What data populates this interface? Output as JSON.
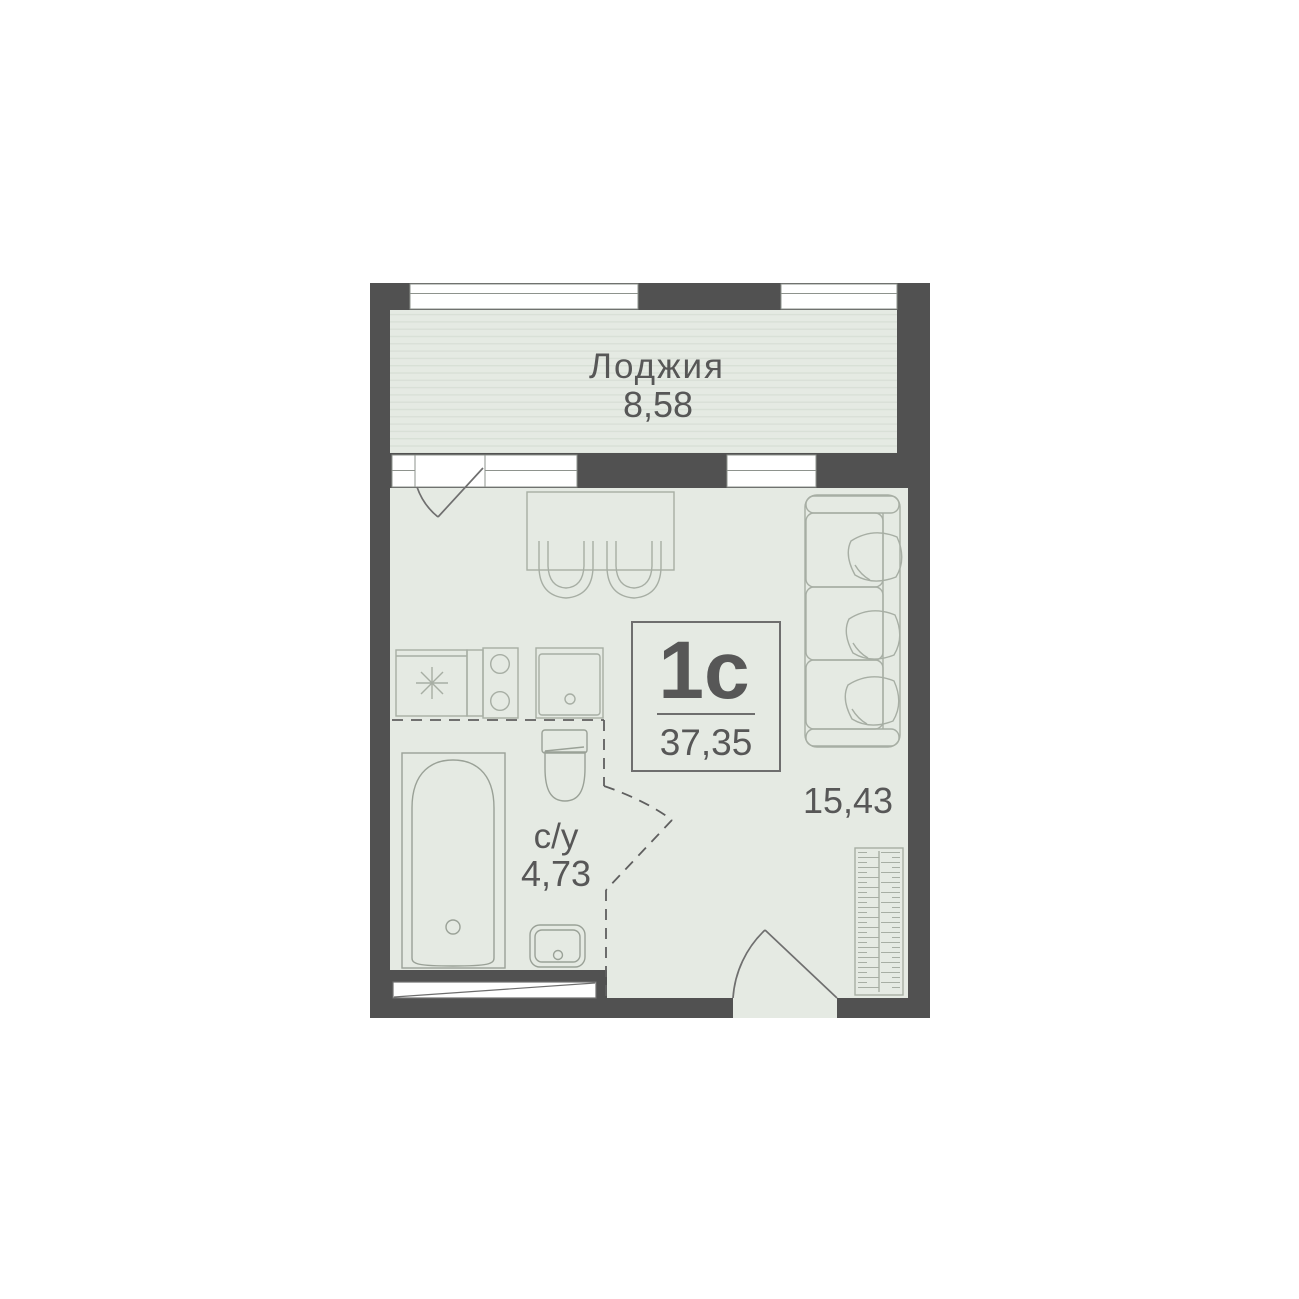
{
  "plan": {
    "unit": {
      "type_label": "1с",
      "total_area": "37,35"
    },
    "rooms": {
      "loggia": {
        "label": "Лоджия",
        "area": "8,58"
      },
      "living_room": {
        "area": "15,43"
      },
      "bathroom": {
        "label": "с/у",
        "area": "4,73"
      }
    },
    "colors": {
      "wall": "#515151",
      "floor": "#e5eae3",
      "loggia_stripe": "#d8dfd6",
      "furniture_line": "#a7aea4",
      "window_frame": "#8e938d",
      "text": "#575757",
      "background": "#ffffff"
    }
  }
}
